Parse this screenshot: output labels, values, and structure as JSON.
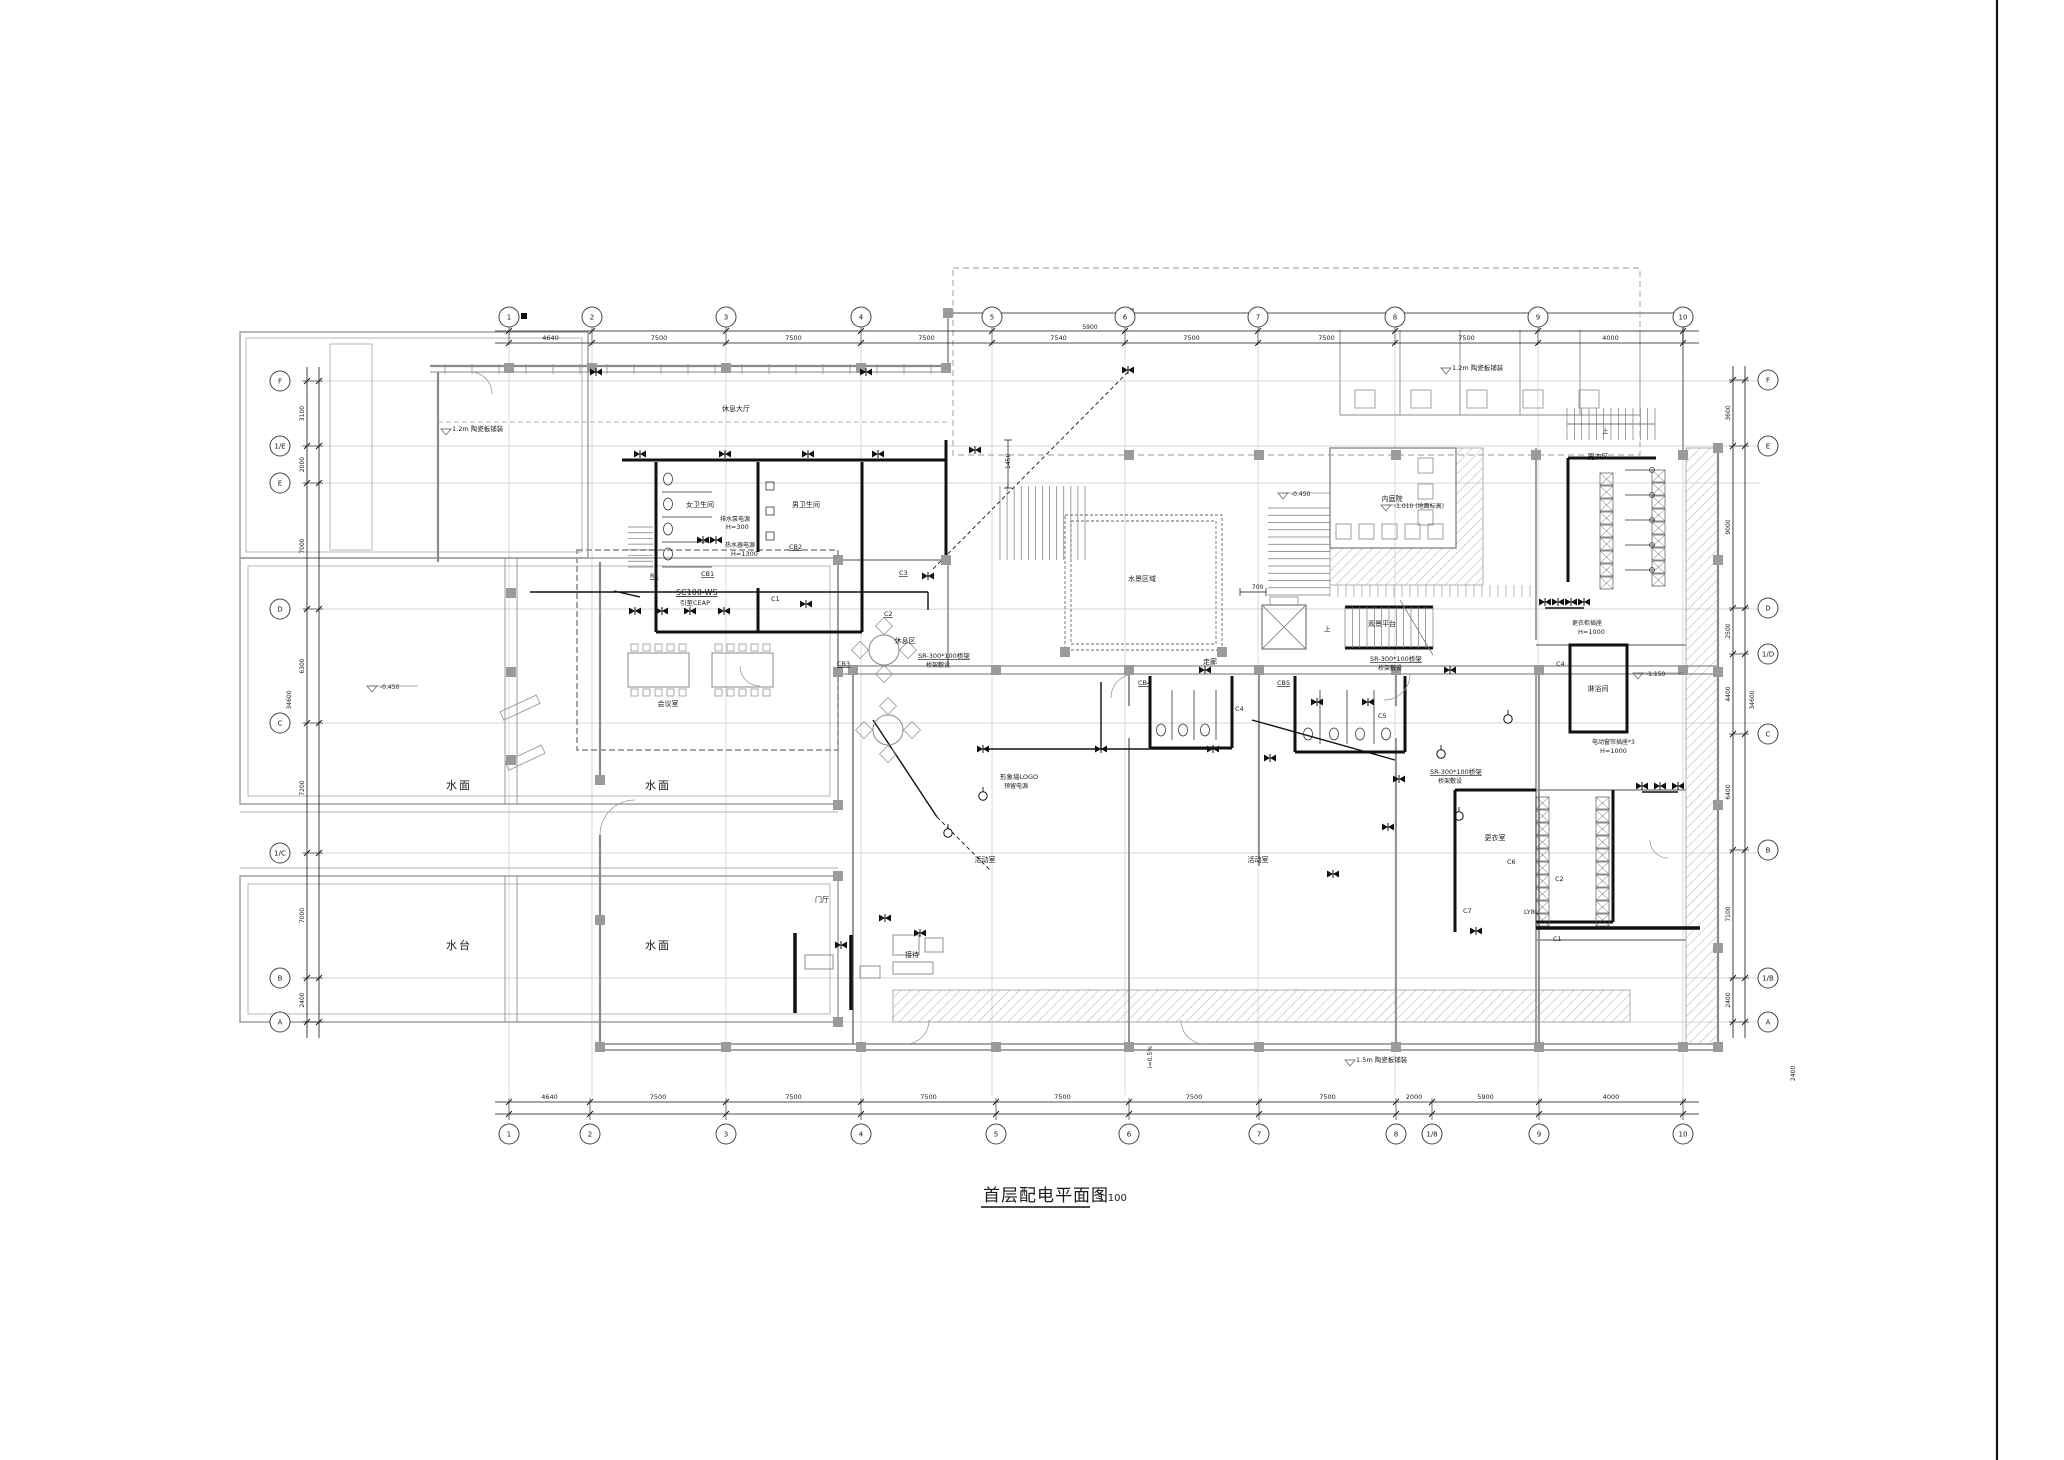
{
  "sheet": {
    "title": "首层配电平面图",
    "scale_label": "1:100",
    "colors": {
      "wall_gray": "#8a8a8a",
      "grid_light": "#c9c9c9",
      "ink_black": "#1a1a1a",
      "label_gray": "#969696",
      "hatch": "#9a9a9a"
    }
  },
  "grid": {
    "top": {
      "labels": [
        "1",
        "2",
        "3",
        "4",
        "5",
        "6",
        "7",
        "8",
        "9",
        "10"
      ],
      "xs": [
        509,
        592,
        726,
        861,
        992,
        1125,
        1258,
        1395,
        1538,
        1683
      ],
      "dims": [
        "4640",
        "7500",
        "7500",
        "7500",
        "7540",
        "7500",
        "7500",
        "7500",
        "4000"
      ],
      "extra_dim": {
        "text": "5900",
        "x": 1090,
        "y": 329
      }
    },
    "bottom": {
      "labels": [
        "1",
        "2",
        "3",
        "4",
        "5",
        "6",
        "7",
        "8",
        "1/8",
        "9",
        "10"
      ],
      "xs": [
        509,
        590,
        726,
        861,
        996,
        1129,
        1259,
        1396,
        1432,
        1539,
        1683
      ],
      "dims": [
        "4640",
        "7500",
        "7500",
        "7500",
        "7500",
        "7500",
        "7500",
        "2000",
        "5900",
        "4000"
      ]
    },
    "left": {
      "labels": [
        "F",
        "1/E",
        "E",
        "D",
        "C",
        "1/C",
        "B",
        "A"
      ],
      "ys": [
        381,
        446,
        483,
        609,
        723,
        853,
        978,
        1022
      ],
      "dims": [
        "3100",
        "2000",
        "7000",
        "6300",
        "7200",
        "7000",
        "2400"
      ],
      "total": "34600"
    },
    "right": {
      "labels": [
        "F",
        "E",
        "D",
        "1/D",
        "C",
        "B",
        "1/B",
        "A"
      ],
      "ys": [
        380,
        446,
        608,
        654,
        734,
        850,
        978,
        1022
      ],
      "dims": [
        "3600",
        "9000",
        "2500",
        "4400",
        "6400",
        "7100",
        "2400"
      ],
      "total": "34600"
    }
  },
  "water_labels": [
    {
      "text": "水面",
      "x": 459,
      "y": 789
    },
    {
      "text": "水面",
      "x": 658,
      "y": 789
    },
    {
      "text": "水台",
      "x": 459,
      "y": 949
    },
    {
      "text": "水面",
      "x": 658,
      "y": 949
    }
  ],
  "room_labels": [
    {
      "text": "休息大厅",
      "x": 736,
      "y": 411
    },
    {
      "text": "女卫生间",
      "x": 700,
      "y": 507
    },
    {
      "text": "男卫生间",
      "x": 806,
      "y": 507
    },
    {
      "text": "会议室",
      "x": 668,
      "y": 706
    },
    {
      "text": "休息区",
      "x": 905,
      "y": 643
    },
    {
      "text": "水景区域",
      "x": 1142,
      "y": 581
    },
    {
      "text": "内庭院",
      "x": 1392,
      "y": 501
    },
    {
      "text": "观景平台",
      "x": 1382,
      "y": 626
    },
    {
      "text": "走廊",
      "x": 1210,
      "y": 664
    },
    {
      "text": "更衣区",
      "x": 1598,
      "y": 459
    },
    {
      "text": "淋浴间",
      "x": 1598,
      "y": 691
    },
    {
      "text": "更衣室",
      "x": 1495,
      "y": 840
    },
    {
      "text": "活动室",
      "x": 985,
      "y": 862
    },
    {
      "text": "活动室",
      "x": 1258,
      "y": 862
    },
    {
      "text": "门厅",
      "x": 822,
      "y": 902
    },
    {
      "text": "接待",
      "x": 912,
      "y": 957
    }
  ],
  "annotations": [
    {
      "text": "SC100-WS",
      "x": 676,
      "y": 595,
      "s": 8,
      "ul": 1
    },
    {
      "text": "引至CEAP",
      "x": 680,
      "y": 605,
      "s": 6.5
    },
    {
      "text": "R1",
      "x": 650,
      "y": 578,
      "ul": 1
    },
    {
      "text": "CB1",
      "x": 701,
      "y": 576,
      "ul": 1
    },
    {
      "text": "CB2",
      "x": 789,
      "y": 549,
      "ul": 1
    },
    {
      "text": "C1",
      "x": 771,
      "y": 601
    },
    {
      "text": "C2",
      "x": 884,
      "y": 616,
      "ul": 1
    },
    {
      "text": "C3",
      "x": 899,
      "y": 575,
      "ul": 1
    },
    {
      "text": "CB3",
      "x": 837,
      "y": 666,
      "ul": 1
    },
    {
      "text": "排水泵电源",
      "x": 720,
      "y": 521,
      "s": 6
    },
    {
      "text": "H=300",
      "x": 726,
      "y": 529,
      "s": 6.5
    },
    {
      "text": "热水器电源",
      "x": 725,
      "y": 547,
      "s": 6
    },
    {
      "text": "H=1300",
      "x": 731,
      "y": 556,
      "s": 6.5
    },
    {
      "text": "SR-300*100桥架",
      "x": 918,
      "y": 658,
      "ul": 1
    },
    {
      "text": "桥架敷设",
      "x": 926,
      "y": 667,
      "s": 6
    },
    {
      "text": "SR-300*100桥架",
      "x": 1370,
      "y": 661,
      "ul": 1
    },
    {
      "text": "桥架敷设",
      "x": 1378,
      "y": 670,
      "s": 6
    },
    {
      "text": "SR-300*100桥架",
      "x": 1430,
      "y": 774,
      "ul": 1
    },
    {
      "text": "桥架敷设",
      "x": 1438,
      "y": 783,
      "s": 6
    },
    {
      "text": "形象墙LOGO",
      "x": 1000,
      "y": 779
    },
    {
      "text": "预留电源",
      "x": 1004,
      "y": 788,
      "s": 6
    },
    {
      "text": "CB4",
      "x": 1138,
      "y": 685,
      "ul": 1
    },
    {
      "text": "CB5",
      "x": 1277,
      "y": 685,
      "ul": 1
    },
    {
      "text": "C4",
      "x": 1235,
      "y": 711
    },
    {
      "text": "C4",
      "x": 1556,
      "y": 666
    },
    {
      "text": "C5",
      "x": 1378,
      "y": 718
    },
    {
      "text": "C6",
      "x": 1507,
      "y": 864
    },
    {
      "text": "C7",
      "x": 1463,
      "y": 913
    },
    {
      "text": "C2",
      "x": 1555,
      "y": 881
    },
    {
      "text": "C1",
      "x": 1553,
      "y": 941
    },
    {
      "text": "LY8L",
      "x": 1524,
      "y": 914
    },
    {
      "text": "电动窗帘插座*3",
      "x": 1592,
      "y": 744,
      "s": 6
    },
    {
      "text": "H=1000",
      "x": 1600,
      "y": 753,
      "s": 6.5
    },
    {
      "text": "更衣柜插座",
      "x": 1572,
      "y": 625,
      "s": 6
    },
    {
      "text": "H=1000",
      "x": 1578,
      "y": 634,
      "s": 6.5
    },
    {
      "text": "1.2m 陶瓷板铺装",
      "x": 452,
      "y": 431,
      "c": "g"
    },
    {
      "text": "1.2m 陶瓷板铺装",
      "x": 1452,
      "y": 370,
      "c": "g"
    },
    {
      "text": "1.5m 陶瓷板铺装",
      "x": 1356,
      "y": 1062,
      "c": "g"
    },
    {
      "text": "i=0.5%",
      "x": 1152,
      "y": 1068,
      "rot": -90,
      "s": 6
    },
    {
      "text": "1450",
      "x": 1010,
      "y": 469,
      "rot": -90,
      "s": 6
    },
    {
      "text": "700",
      "x": 1252,
      "y": 589,
      "s": 6
    },
    {
      "text": "上",
      "x": 1324,
      "y": 631,
      "s": 6.5
    },
    {
      "text": "上",
      "x": 1602,
      "y": 433,
      "s": 6.5
    },
    {
      "text": "2400",
      "x": 1795,
      "y": 1081,
      "rot": -90,
      "s": 6
    }
  ],
  "levels": [
    {
      "text": "-0.450",
      "x": 372,
      "y": 691
    },
    {
      "text": "-0.450",
      "x": 1283,
      "y": 498
    },
    {
      "text": "-1.010 (地面标高)",
      "x": 1386,
      "y": 510
    },
    {
      "text": "-1.150",
      "x": 1638,
      "y": 678
    },
    {
      "text": "",
      "x": 446,
      "y": 434
    },
    {
      "text": "",
      "x": 1446,
      "y": 373
    },
    {
      "text": "",
      "x": 1350,
      "y": 1065
    }
  ],
  "legend": {
    "bowtie_symbol": "配电设备/灯具",
    "circle_symbol": "动力设备"
  },
  "electrical": {
    "bowtie_points": [
      [
        640,
        454
      ],
      [
        725,
        454
      ],
      [
        808,
        454
      ],
      [
        878,
        454
      ],
      [
        975,
        450
      ],
      [
        703,
        540
      ],
      [
        716,
        540
      ],
      [
        635,
        611
      ],
      [
        662,
        611
      ],
      [
        690,
        611
      ],
      [
        724,
        611
      ],
      [
        928,
        576
      ],
      [
        806,
        604
      ],
      [
        983,
        749
      ],
      [
        1101,
        749
      ],
      [
        1213,
        749
      ],
      [
        885,
        918
      ],
      [
        920,
        933
      ],
      [
        841,
        945
      ],
      [
        1270,
        758
      ],
      [
        1399,
        779
      ],
      [
        1333,
        874
      ],
      [
        1388,
        827
      ],
      [
        1476,
        931
      ],
      [
        1545,
        602
      ],
      [
        1558,
        602
      ],
      [
        1571,
        602
      ],
      [
        1584,
        602
      ],
      [
        1642,
        786
      ],
      [
        1660,
        786
      ],
      [
        1678,
        786
      ],
      [
        1128,
        370
      ],
      [
        1205,
        670
      ],
      [
        1450,
        670
      ],
      [
        1317,
        702
      ],
      [
        1368,
        702
      ],
      [
        596,
        372
      ],
      [
        866,
        372
      ]
    ],
    "device_points": [
      [
        983,
        796
      ],
      [
        948,
        833
      ],
      [
        1508,
        719
      ],
      [
        1459,
        816
      ],
      [
        1441,
        754
      ]
    ]
  }
}
